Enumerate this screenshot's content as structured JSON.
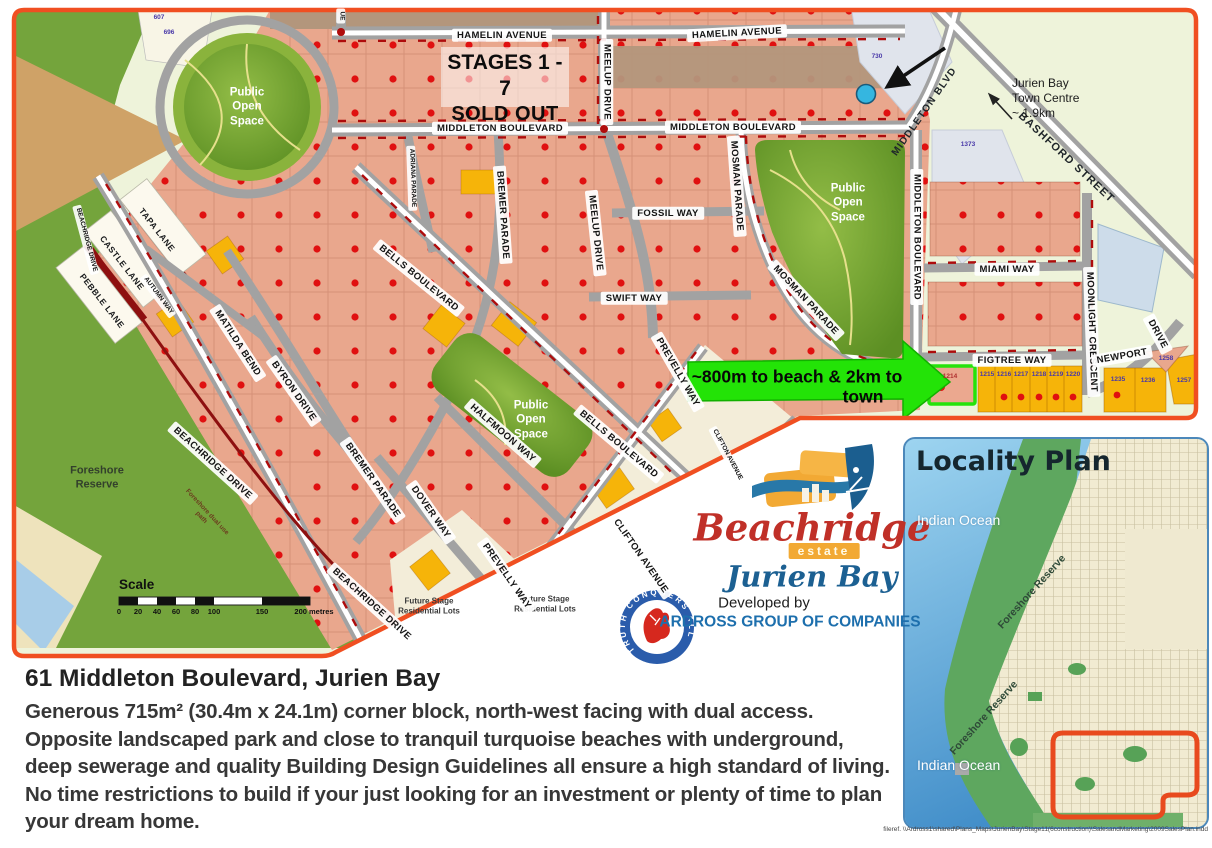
{
  "map": {
    "stages": {
      "line1": "STAGES 1 - 7",
      "line2": "SOLD OUT"
    },
    "street_labels": {
      "hamelin": "HAMELIN AVENUE",
      "middleton": "MIDDLETON BOULEVARD",
      "middleton_short": "MIDDLETON BLVD",
      "meelup": "MEELUP DRIVE",
      "adriana": "ADRIANA PARADE",
      "bremer": "BREMER PARADE",
      "bells": "BELLS BOULEVARD",
      "fossil": "FOSSIL WAY",
      "swift": "SWIFT WAY",
      "mosman": "MOSMAN PARADE",
      "miami": "MIAMI WAY",
      "figtree": "FIGTREE WAY",
      "moonlight": "MOONLIGHT CRESCENT",
      "newport": "NEWPORT",
      "newport_drive": "DRIVE",
      "bashford": "BASHFORD STREET",
      "matilda": "MATILDA BEND",
      "byron": "BYRON DRIVE",
      "autumn": "AUTUMN WAY",
      "tapa": "TAPA LANE",
      "castle": "CASTLE LANE",
      "pebble": "PEBBLE LANE",
      "beachridge": "BEACHRIDGE DRIVE",
      "dover": "DOVER WAY",
      "halfmoon": "HALFMOON WAY",
      "prevelly": "PREVELLY WAY",
      "clifton": "CLIFTON AVENUE",
      "stub": "UE"
    },
    "labels": {
      "public_open_space": "Public Open Space",
      "foreshore_reserve": "Foreshore Reserve",
      "foreshore_path": "Foreshore dual use path",
      "future_stage": "Future Stage Residential Lots",
      "town_centre": "Jurien Bay\nTown Centre\n~ 1.9km",
      "beach_arrow_1": "~800m to beach & 2km to",
      "beach_arrow_2": "town"
    },
    "scale": {
      "title": "Scale",
      "ticks": [
        "0",
        "20",
        "40",
        "60",
        "80",
        "100",
        "150",
        "200 metres"
      ]
    },
    "lots": {
      "highlight": "1214",
      "l607": "607",
      "l696": "696",
      "l730": "730",
      "l1373": "1373",
      "row": [
        "1215",
        "1216",
        "1217",
        "1218",
        "1219",
        "1220"
      ],
      "l1235": "1235",
      "l1236": "1236",
      "l1257": "1257",
      "l1258": "1258"
    }
  },
  "branding": {
    "estate_name": "Beachridge",
    "estate_word": "estate",
    "location": "Jurien Bay",
    "developed_by": "Developed by",
    "developer": "ARDROSS GROUP OF COMPANIES",
    "crest_motto": "TRUTH CONQUERS ALL"
  },
  "locality": {
    "title": "Locality Plan",
    "ocean_1": "Indian Ocean",
    "ocean_2": "Indian Ocean",
    "reserve_1": "Foreshore Reserve",
    "reserve_2": "Foreshore Reserve"
  },
  "description": {
    "title": "61 Middleton Boulevard, Jurien Bay",
    "lines": [
      "Generous 715m² (30.4m x 24.1m) corner block, north-west facing with dual access.",
      "Opposite landscaped park and close to tranquil turquoise beaches with underground,",
      "deep sewerage and quality Building Design Guidelines all ensure a high standard of living.",
      "No time restrictions to build if your just looking for an investment or plenty of time to plan",
      "your dream home."
    ]
  },
  "footer": {
    "fileref": "fileref. \\\\Ardross1\\shared\\Plans_Maps\\JurienBay\\Stage11(6construction)\\SalesandMarketing\\2009SalesPlan.indd"
  },
  "colors": {
    "map_border": "#f04f21",
    "lot_salmon": "#e9a78d",
    "lot_yellow": "#f6b409",
    "sold_dot_red": "#e01010",
    "park_green": "#6f9e33",
    "foreshore_green": "#74a43c",
    "arrow_green": "#23e307",
    "highlight_green": "#25e30a",
    "road_grey": "#a2a2a2",
    "ocean_blue": "#3f8cc8"
  }
}
